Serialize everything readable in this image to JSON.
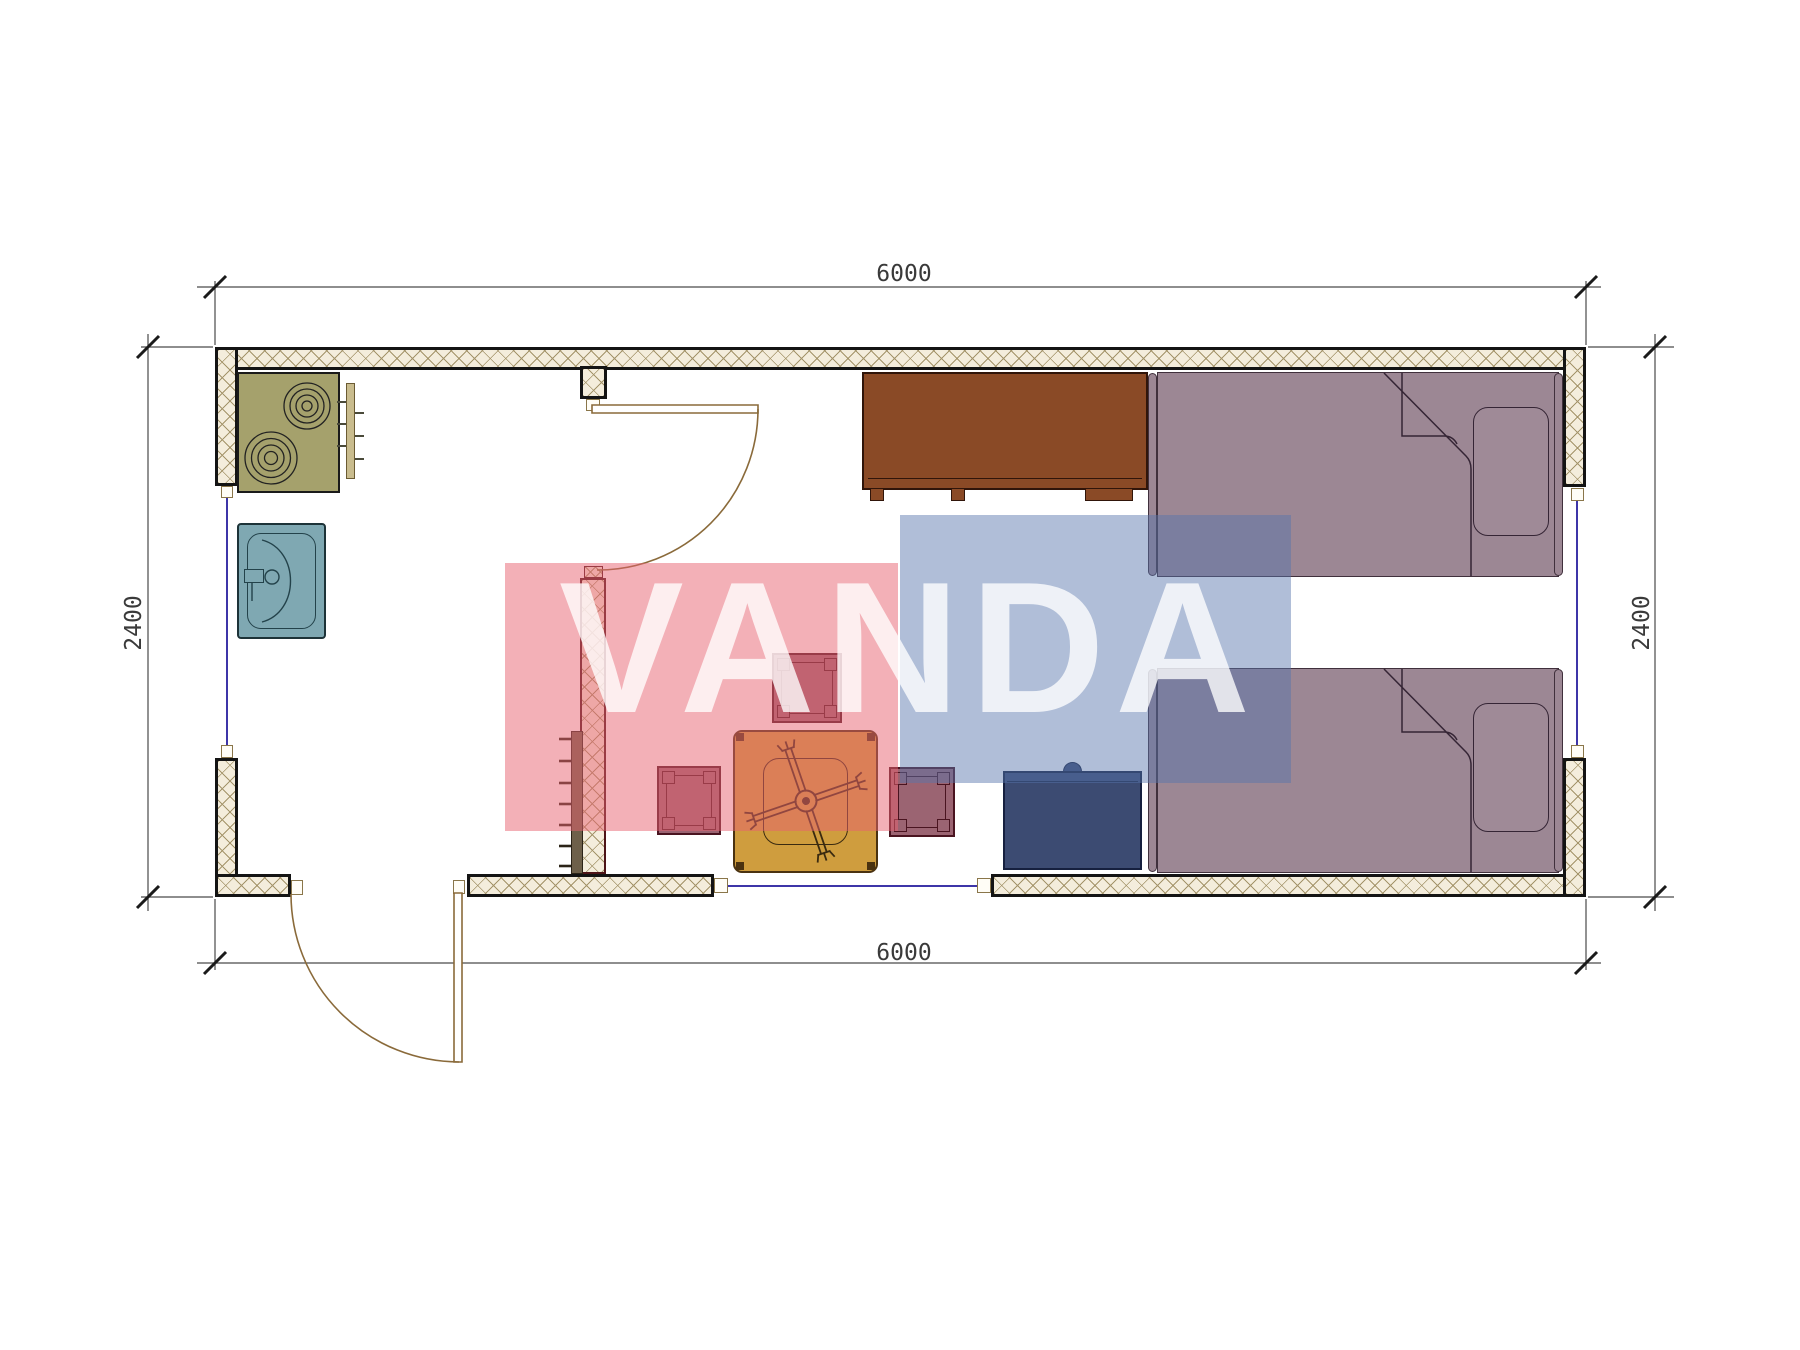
{
  "drawing": {
    "type": "floor-plan",
    "unit_width_mm": "6000",
    "unit_depth_mm": "2400"
  },
  "dimensions": {
    "top": "6000",
    "bottom": "6000",
    "left": "2400",
    "right": "2400"
  },
  "watermark": {
    "text": "VANDA",
    "pink_color": "#e86170",
    "blue_color": "#5874ac",
    "letter_color": "#ffffff"
  },
  "colors": {
    "wall_fill": "#f4eddc",
    "wall_hatch": "#a4946a",
    "outer_wall_line": "#141414",
    "partition_line": "#4d1418",
    "stove": "#a5a16c",
    "sink": "#7fa8b2",
    "wardrobe": "#8a4a26",
    "nightstand": "#3c4b72",
    "bed": "#9c8794",
    "table": "#cf9d3e",
    "stool": "#9b6472",
    "window_line": "#3d35a8",
    "door_line": "#8a6a3a"
  },
  "furniture_icons": [
    "stove-icon",
    "sink-icon",
    "dish-rack-icon",
    "wardrobe-icon",
    "bed-icon",
    "bed-icon",
    "nightstand-icon",
    "table-icon",
    "stool-icon",
    "stool-icon",
    "stool-icon",
    "wall-rack-icon"
  ]
}
